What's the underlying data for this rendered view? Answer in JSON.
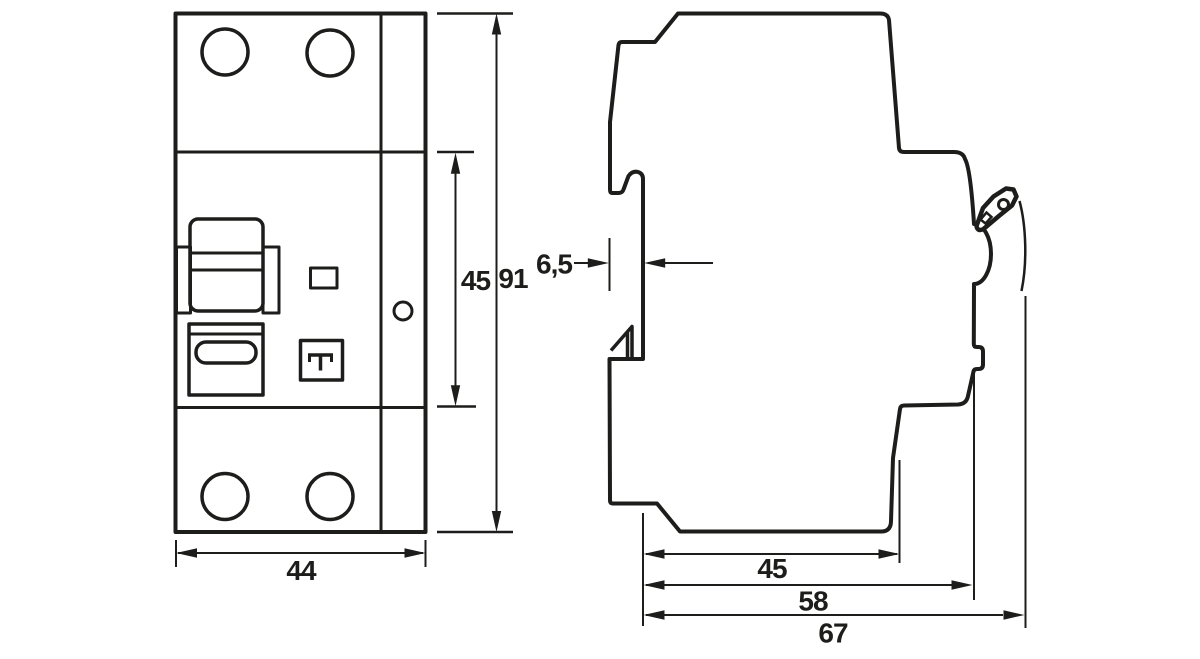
{
  "drawing": {
    "background": "#ffffff",
    "stroke_color": "#1d1d1b",
    "front_view": {
      "dim_width": "44",
      "dim_module_height": "45",
      "dim_total_height": "91"
    },
    "side_view": {
      "dim_front_offset": "6,5",
      "dim_rail_depth": "45",
      "dim_body_depth": "58",
      "dim_total_depth": "67"
    }
  }
}
